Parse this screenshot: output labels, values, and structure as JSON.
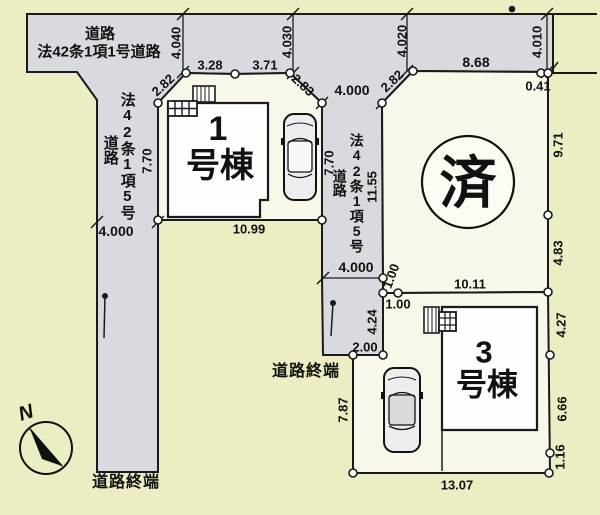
{
  "plan": {
    "main_road": {
      "line1": "道路",
      "line2": "法42条1項1号道路"
    },
    "left_road": {
      "name": "法42条1項5号",
      "suffix": "道路",
      "end_label": "道路終端"
    },
    "center_road": {
      "name": "法42条1項5号",
      "suffix": "道路",
      "end_label": "道路終端"
    },
    "lot1": {
      "num": "1",
      "suffix": "号棟"
    },
    "lot2": {
      "status": "済"
    },
    "lot3": {
      "num": "3",
      "suffix": "号棟"
    },
    "compass": {
      "north": "N"
    },
    "dims": {
      "d4040": "4.040",
      "d4030": "4.030",
      "d4020": "4.020",
      "d4010": "4.010",
      "d328": "3.28",
      "d371": "3.71",
      "d282l": "2.82",
      "d283": "2.83",
      "d282r": "2.82",
      "d868": "8.68",
      "d041": "0.41",
      "d400t": "4.000",
      "d400l": "4.000",
      "d400b": "4.000",
      "d770a": "7.70",
      "d770b": "7.70",
      "d1155": "11.55",
      "d971": "9.71",
      "d483": "4.83",
      "d1099": "10.99",
      "d100v": "1.00",
      "d100h": "1.00",
      "d1011": "10.11",
      "d424": "4.24",
      "d200": "2.00",
      "d427": "4.27",
      "d666": "6.66",
      "d116": "1.16",
      "d1307": "13.07",
      "d787": "7.87"
    }
  }
}
